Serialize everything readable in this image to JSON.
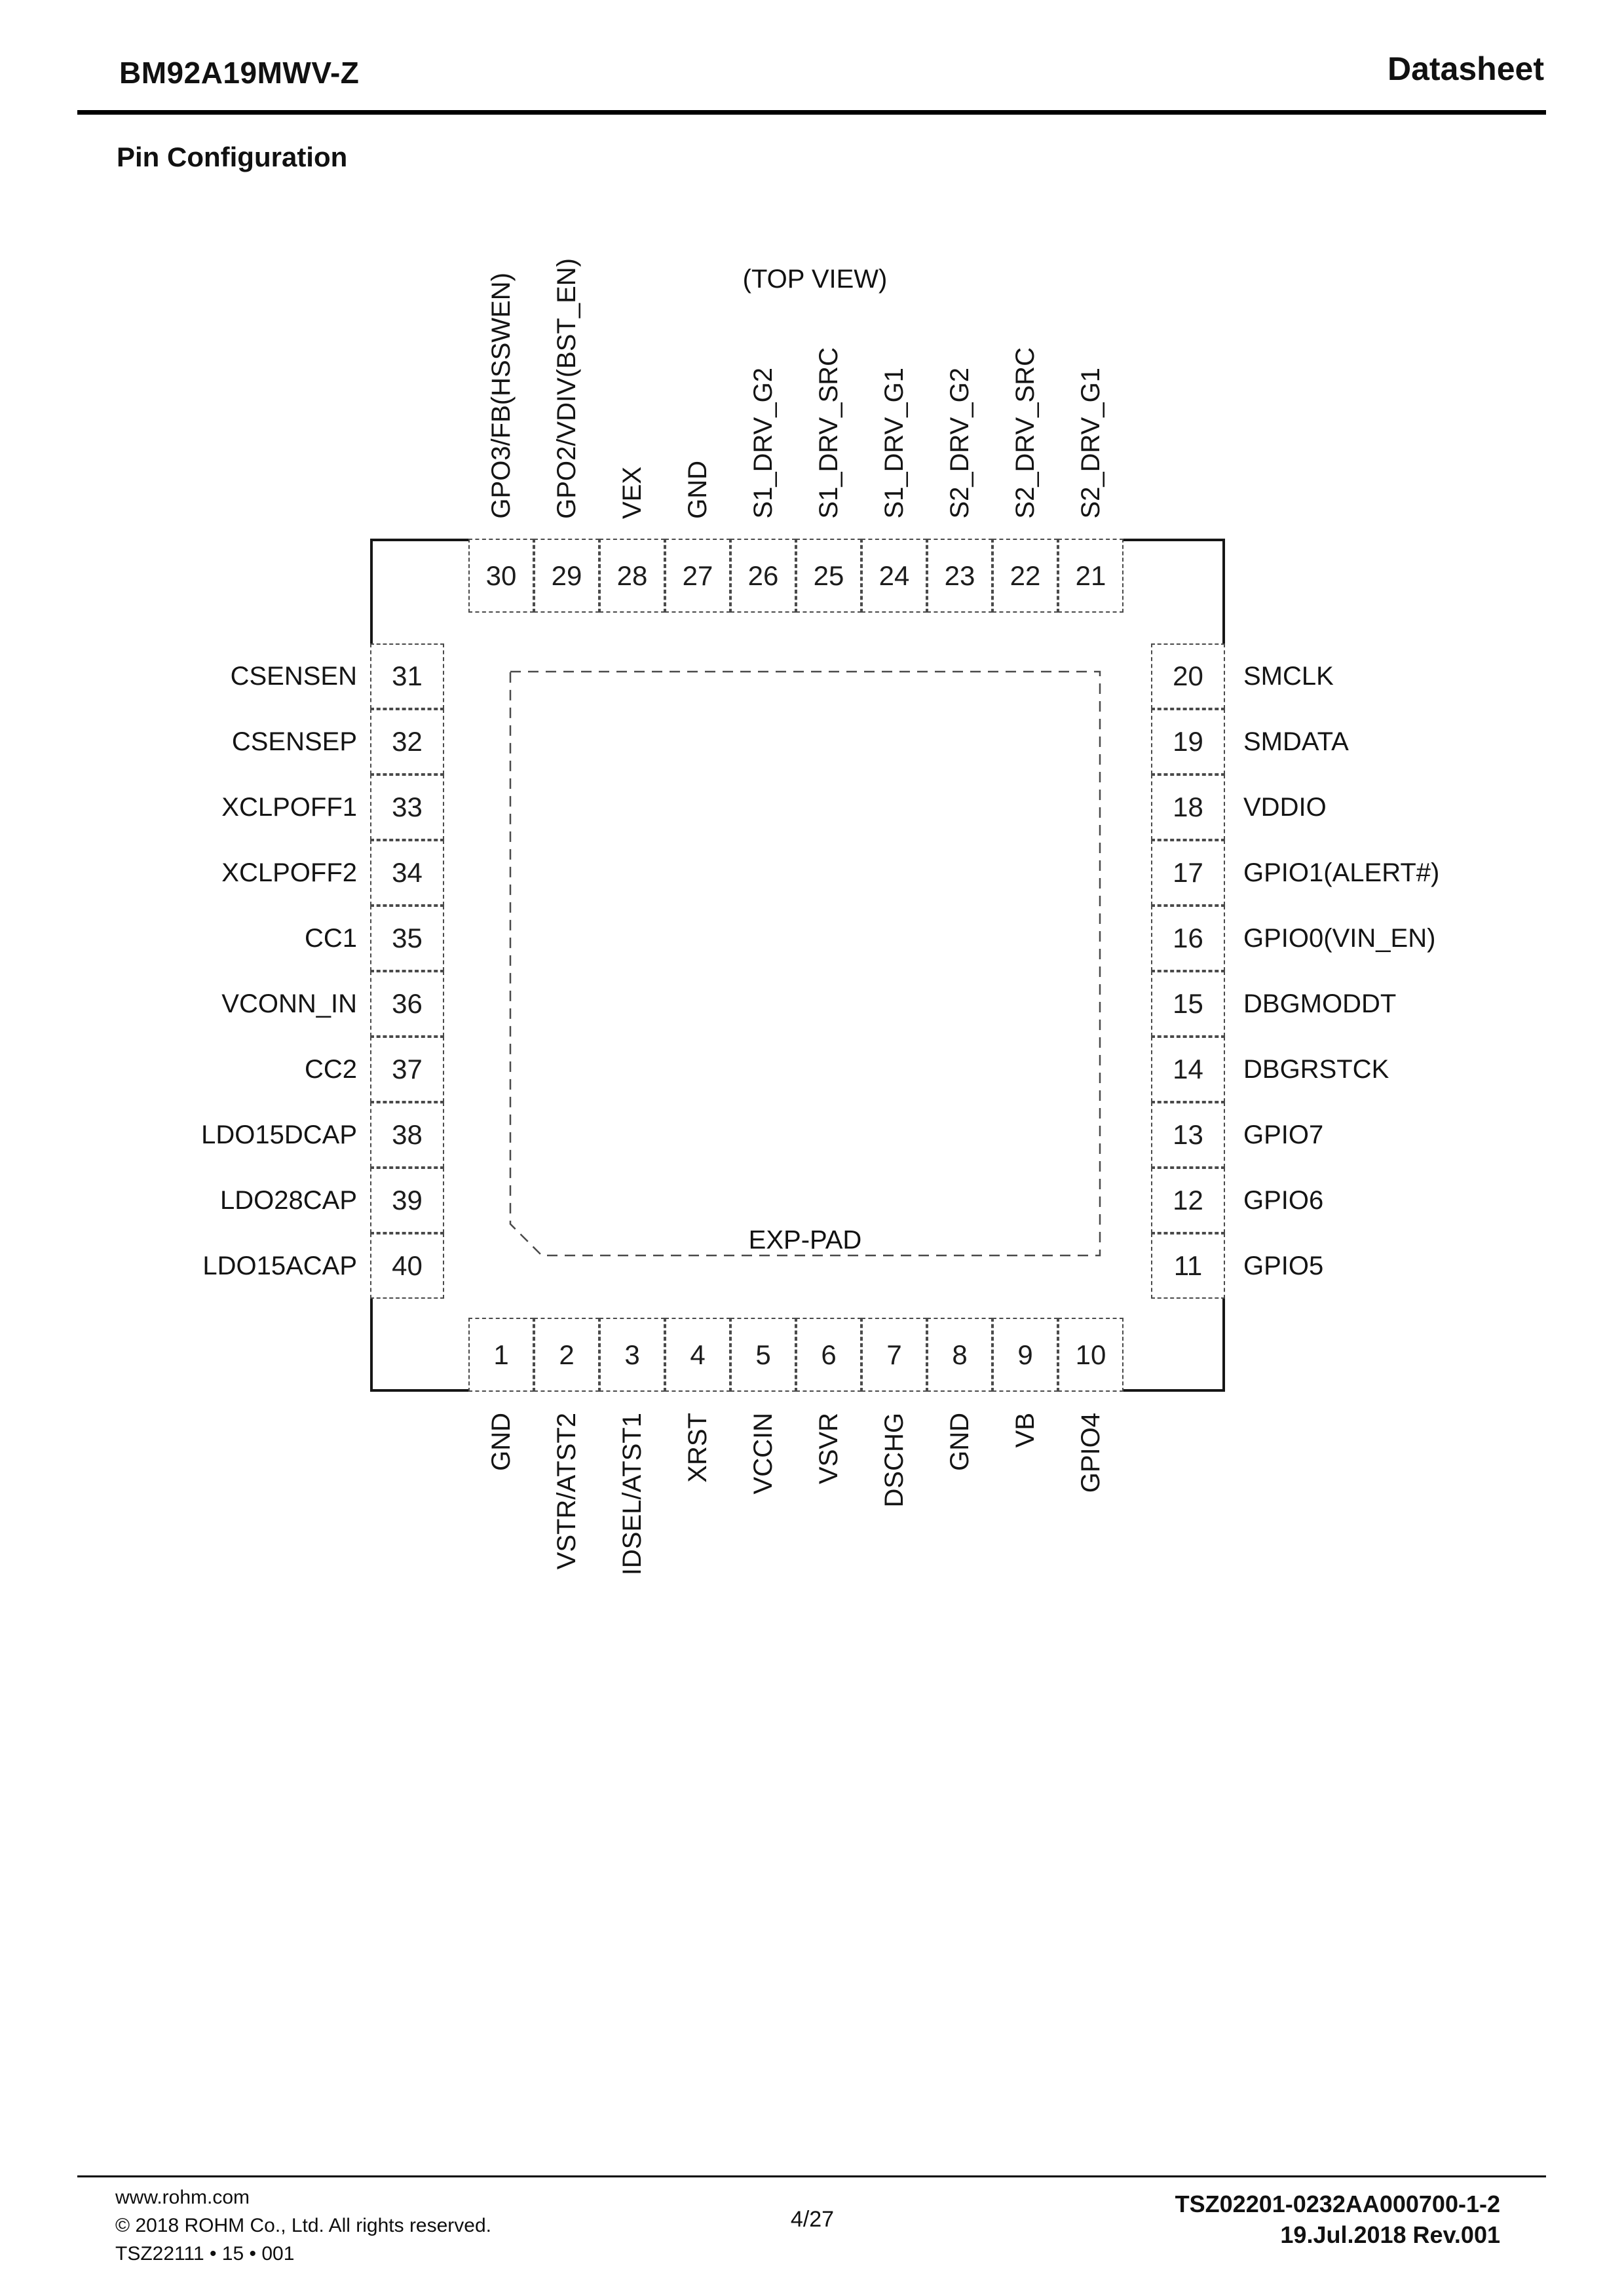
{
  "header": {
    "part_number": "BM92A19MWV-Z",
    "doc_type": "Datasheet"
  },
  "section_title": "Pin Configuration",
  "diagram": {
    "view_label": "(TOP VIEW)",
    "exp_pad_label": "EXP-PAD",
    "top_pins": [
      {
        "num": "30",
        "label": "GPO3/FB(HSSWEN)"
      },
      {
        "num": "29",
        "label": "GPO2/VDIV(BST_EN)"
      },
      {
        "num": "28",
        "label": "VEX"
      },
      {
        "num": "27",
        "label": "GND"
      },
      {
        "num": "26",
        "label": "S1_DRV_G2"
      },
      {
        "num": "25",
        "label": "S1_DRV_SRC"
      },
      {
        "num": "24",
        "label": "S1_DRV_G1"
      },
      {
        "num": "23",
        "label": "S2_DRV_G2"
      },
      {
        "num": "22",
        "label": "S2_DRV_SRC"
      },
      {
        "num": "21",
        "label": "S2_DRV_G1"
      }
    ],
    "left_pins": [
      {
        "num": "31",
        "label": "CSENSEN"
      },
      {
        "num": "32",
        "label": "CSENSEP"
      },
      {
        "num": "33",
        "label": "XCLPOFF1"
      },
      {
        "num": "34",
        "label": "XCLPOFF2"
      },
      {
        "num": "35",
        "label": "CC1"
      },
      {
        "num": "36",
        "label": "VCONN_IN"
      },
      {
        "num": "37",
        "label": "CC2"
      },
      {
        "num": "38",
        "label": "LDO15DCAP"
      },
      {
        "num": "39",
        "label": "LDO28CAP"
      },
      {
        "num": "40",
        "label": "LDO15ACAP"
      }
    ],
    "right_pins": [
      {
        "num": "20",
        "label": "SMCLK"
      },
      {
        "num": "19",
        "label": "SMDATA"
      },
      {
        "num": "18",
        "label": "VDDIO"
      },
      {
        "num": "17",
        "label": "GPIO1(ALERT#)"
      },
      {
        "num": "16",
        "label": "GPIO0(VIN_EN)"
      },
      {
        "num": "15",
        "label": "DBGMODDT"
      },
      {
        "num": "14",
        "label": "DBGRSTCK"
      },
      {
        "num": "13",
        "label": "GPIO7"
      },
      {
        "num": "12",
        "label": "GPIO6"
      },
      {
        "num": "11",
        "label": "GPIO5"
      }
    ],
    "bottom_pins": [
      {
        "num": "1",
        "label": "GND"
      },
      {
        "num": "2",
        "label": "VSTR/ATST2"
      },
      {
        "num": "3",
        "label": "IDSEL/ATST1"
      },
      {
        "num": "4",
        "label": "XRST"
      },
      {
        "num": "5",
        "label": "VCCIN"
      },
      {
        "num": "6",
        "label": "VSVR"
      },
      {
        "num": "7",
        "label": "DSCHG"
      },
      {
        "num": "8",
        "label": "GND"
      },
      {
        "num": "9",
        "label": "VB"
      },
      {
        "num": "10",
        "label": "GPIO4"
      }
    ]
  },
  "footer": {
    "website": "www.rohm.com",
    "copyright": "© 2018 ROHM Co., Ltd. All rights reserved.",
    "doc_control": "TSZ22111 • 15 • 001",
    "page_indicator": "4/27",
    "doc_number": "TSZ02201-0232AA000700-1-2",
    "revision": "19.Jul.2018 Rev.001"
  }
}
